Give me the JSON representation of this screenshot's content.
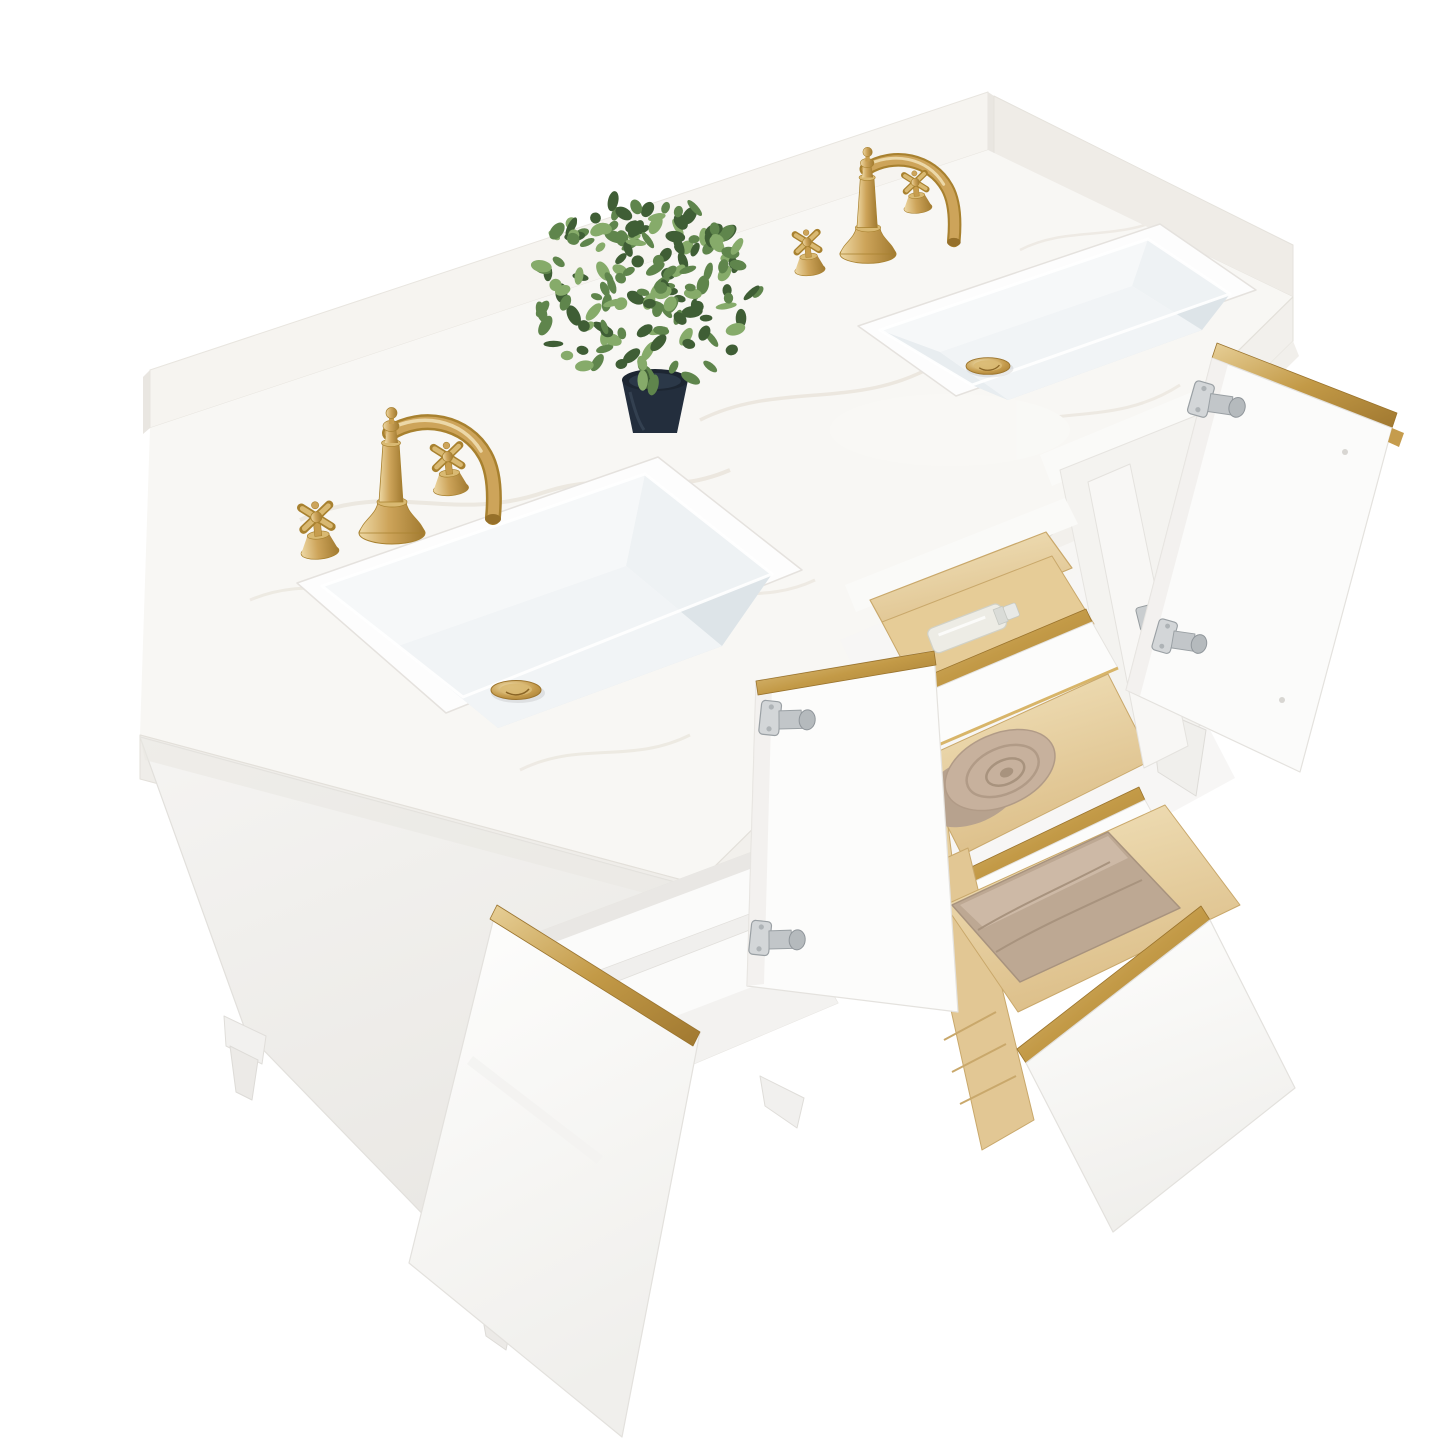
{
  "meta": {
    "description": "Product photo of a white double-sink bathroom vanity with engineered-marble top and backsplash, two brushed-gold vintage widespread faucets with cross handles, open doors and drawers revealing pine drawer boxes, gold edge trim, satin-nickel hinges, towels, a tip-out tray with a perfume bottle and lipstick, and a faux eucalyptus plant in a navy pot"
  },
  "colors": {
    "background": "#ffffff",
    "marble": "#f7f6f3",
    "marble_vein": "#e7e2d9",
    "marble_edge": "#edebe7",
    "cabinet_white": "#fcfcfb",
    "cabinet_shadow": "#ebe9e6",
    "panel_light": "#f5f4f2",
    "panel_dark": "#e9e7e4",
    "interior_white": "#fafaf9",
    "gold": "#c59c4d",
    "gold_light": "#ecd8a8",
    "gold_dark": "#9a732c",
    "pine": "#ead7a8",
    "pine_dark": "#d9ba84",
    "pine_shadow": "#c9a86b",
    "towel": "#c7b19d",
    "towel_dark": "#b19b87",
    "pot_navy": "#1d2632",
    "leaf_dark": "#3f5e35",
    "leaf_mid": "#5f854c",
    "leaf_light": "#86ab6a",
    "nickel": "#c9cdcf",
    "nickel_dark": "#969c9f",
    "basin_shade": "#dde4e8",
    "basin_light": "#f2f5f6"
  },
  "scene": {
    "countertop": {
      "material": "white engineered marble with backsplash",
      "backsplash": true,
      "side_return": true
    },
    "sinks": {
      "count": 2,
      "shape": "rectangular undermount",
      "drain_finish": "brushed gold"
    },
    "faucets": {
      "count": 2,
      "style": "vintage widespread",
      "finish": "brushed gold",
      "handles_per_faucet": 2,
      "handle_type": "cross"
    },
    "cabinet": {
      "finish": "matte white",
      "open_doors": 3,
      "open_drawers": 2,
      "tipout_tray_open": true,
      "shelf_count": 1,
      "trim_finish": "brushed gold",
      "hinge_finish": "satin nickel",
      "drawer_box_material": "natural pine",
      "legs_visible": 4
    },
    "accessories": {
      "towels": [
        {
          "style": "rolled",
          "color_name": "taupe"
        },
        {
          "style": "folded",
          "color_name": "taupe"
        }
      ],
      "tray_items": [
        "glass perfume bottle",
        "black lipstick"
      ]
    },
    "plant_label": "faux eucalyptus in navy pot"
  },
  "plant": {
    "cx": 645,
    "cy": 292,
    "radius": 106,
    "leaf_count": 170
  }
}
